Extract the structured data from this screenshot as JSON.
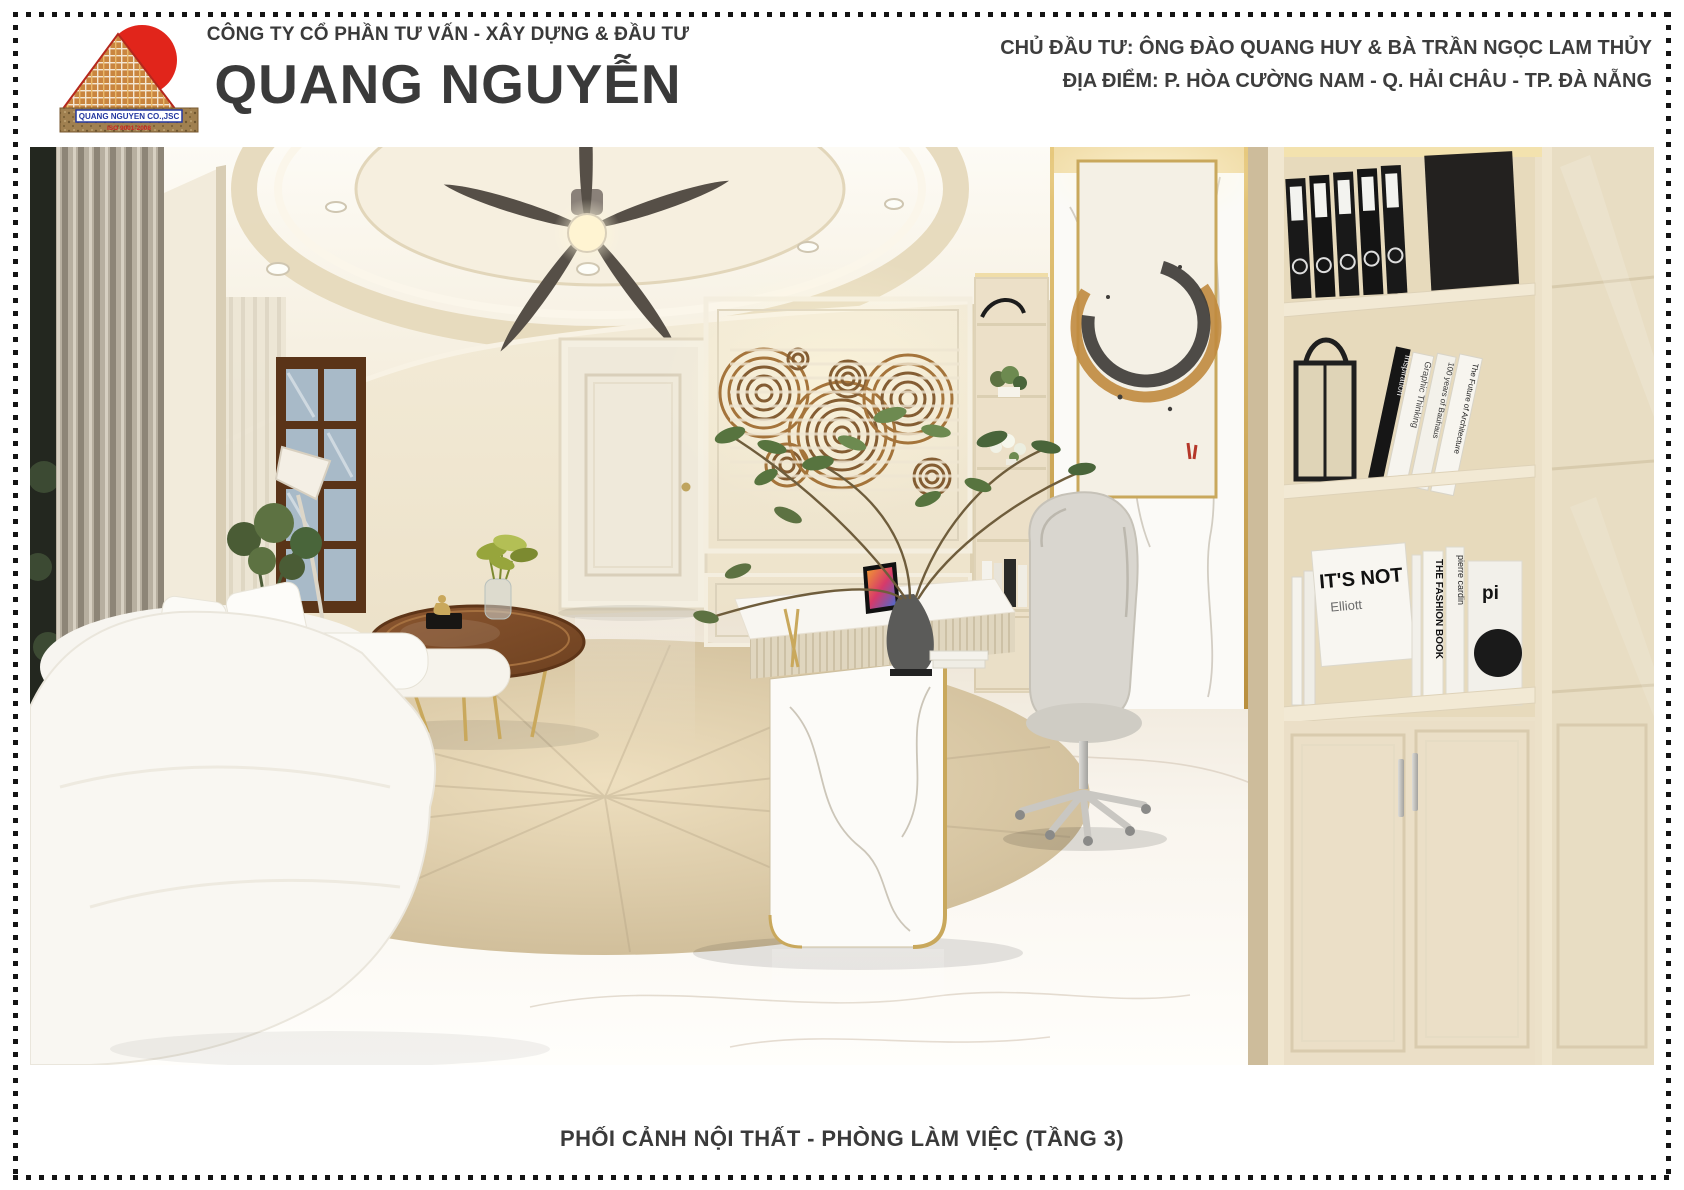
{
  "header": {
    "tagline": "CÔNG TY CỔ PHẦN TƯ VẤN - XÂY DỰNG & ĐẦU TƯ",
    "company_name": "QUANG NGUYỄN",
    "investor_line": "CHỦ ĐẦU TƯ: ÔNG ĐÀO QUANG HUY & BÀ TRẦN NGỌC LAM THỦY",
    "location_line": "ĐỊA ĐIỂM: P. HÒA CƯỜNG NAM - Q. HẢI CHÂU - TP. ĐÀ NẴNG",
    "logo": {
      "banner_text": "QUANG NGUYEN CO.,JSC",
      "iso_text": "ISO 9001-2008"
    }
  },
  "footer": {
    "caption": "PHỐI CẢNH NỘI THẤT - PHÒNG LÀM VIỆC (TẦNG 3)"
  },
  "scene": {
    "description": "3D interior render of an office room (floor 3)",
    "leaning_books": [
      "Inspiration",
      "Graphic Thinking",
      "100 years of Bauhaus",
      "The Future of Architecture"
    ],
    "white_books": [
      "IT'S NOT",
      "Elliott",
      "THE FASHION BOOK",
      "pierre cardin",
      "pi"
    ]
  },
  "colors": {
    "logo_red": "#e1251b",
    "logo_blue": "#2438a0",
    "brick_orange": "#c9853f",
    "text_dark": "#3a3a3a",
    "wall_cream": "#efe6d2",
    "gold": "#c9a85c",
    "map_brown": "#754a1d",
    "fan_blade": "#564f47",
    "marble_white": "#fbfaf7"
  }
}
